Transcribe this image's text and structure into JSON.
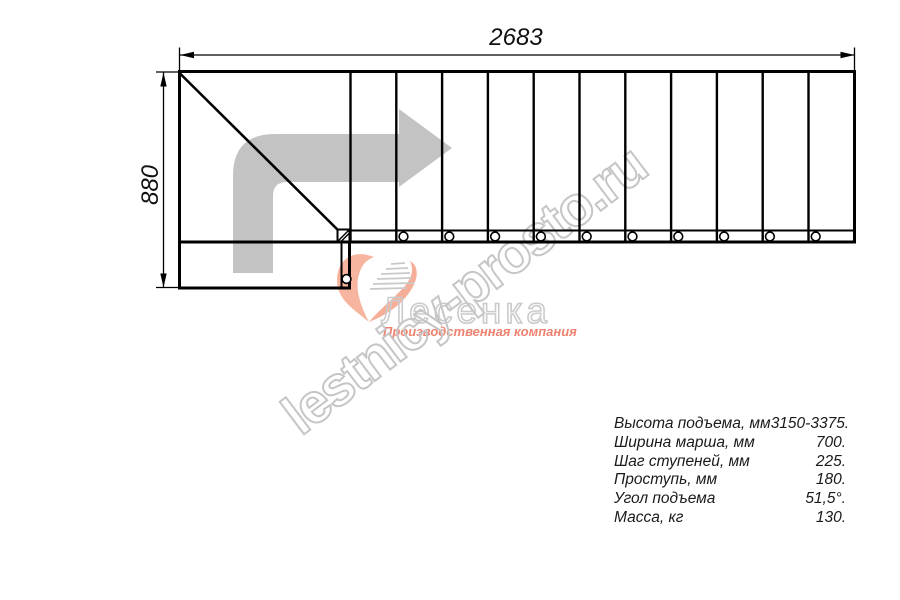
{
  "drawing": {
    "title": "staircase-plan-view",
    "dim_width_label": "2683",
    "dim_height_label": "880"
  },
  "watermark": {
    "text": "lestnicy-prosto.ru"
  },
  "logo": {
    "name": "Лесенка",
    "tagline": "Производственная компания"
  },
  "specs": {
    "rows": [
      {
        "label": "Высота подъема, мм",
        "value": "3150-3375."
      },
      {
        "label": "Ширина марша, мм",
        "value": "700."
      },
      {
        "label": "Шаг ступеней, мм",
        "value": "225."
      },
      {
        "label": "Проступь, мм",
        "value": "180."
      },
      {
        "label": "Угол подъема",
        "value": "51,5°."
      },
      {
        "label": "Масса, кг",
        "value": "130."
      }
    ]
  },
  "colors": {
    "line": "#000000",
    "direction_arrow": "#c3c3c3",
    "watermark_stroke": "#c6c6c6",
    "logo_swoosh": "#f6ac95",
    "logo_tagline": "#ee8270"
  }
}
